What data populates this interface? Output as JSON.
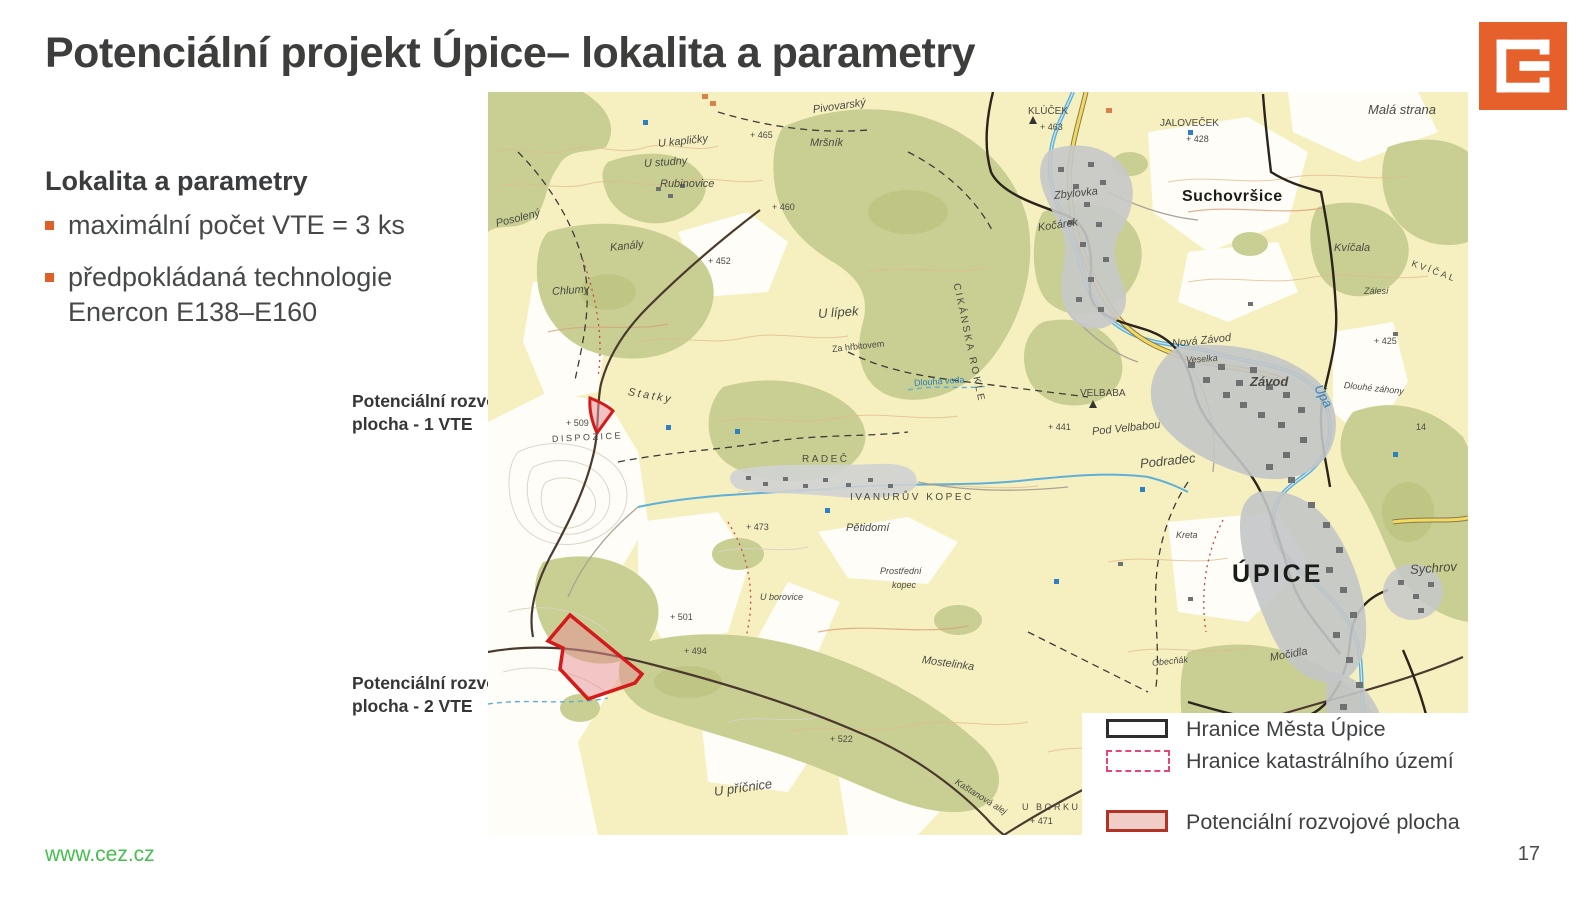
{
  "slide": {
    "title": "Potenciální projekt Úpice– lokalita a parametry",
    "page_number": "17",
    "footer_link": "www.cez.cz",
    "accent_orange": "#de5f28",
    "footer_green": "#43bf4c"
  },
  "logo": {
    "name": "cez-logo",
    "color": "#e5602b"
  },
  "panel": {
    "heading": "Lokalita a parametry",
    "bullets": [
      "maximální počet VTE = 3 ks",
      "předpokládaná technologie Enercon E138–E160"
    ]
  },
  "callouts": [
    {
      "label": "Potenciální rozvojová plocha - 1 VTE"
    },
    {
      "label": "Potenciální rozvojová plocha - 2 VTE"
    }
  ],
  "legend": {
    "items": [
      {
        "label": "Hranice Města Úpice",
        "swatch": "city-boundary"
      },
      {
        "label": "Hranice katastrálního území",
        "swatch": "cadastral-boundary"
      },
      {
        "label": "Potenciální rozvojové plocha",
        "swatch": "development-area"
      }
    ]
  },
  "map": {
    "colors": {
      "field_cream": "#f6f0c0",
      "forest_olive": "#c9cf92",
      "water_blue": "#5fb0d8",
      "road_dark": "#4a3a2e",
      "urban_gray": "#c3c5c7",
      "development_red": "#d41a1a",
      "development_fill": "#e89096",
      "cadastral_pink": "#e5467d"
    },
    "labels": [
      {
        "text": "Pivovarský",
        "x": 325,
        "y": 12,
        "cls": "it",
        "rot": -8
      },
      {
        "text": "Mršník",
        "x": 322,
        "y": 45,
        "cls": "it"
      },
      {
        "text": "+ 465",
        "x": 262,
        "y": 38,
        "cls": "xs"
      },
      {
        "text": "KLÚČEK",
        "x": 540,
        "y": 14,
        "cls": "sm"
      },
      {
        "text": "+ 463",
        "x": 552,
        "y": 30,
        "cls": "xs"
      },
      {
        "text": "JALOVEČEK",
        "x": 672,
        "y": 26,
        "cls": "sm"
      },
      {
        "text": "Malá strana",
        "x": 880,
        "y": 10,
        "cls": "it lg"
      },
      {
        "text": "+ 428",
        "x": 698,
        "y": 42,
        "cls": "xs"
      },
      {
        "text": "Suchovršice",
        "x": 694,
        "y": 96,
        "cls": "town"
      },
      {
        "text": "U kapličky",
        "x": 170,
        "y": 46,
        "cls": "it",
        "rot": -6
      },
      {
        "text": "U studny",
        "x": 156,
        "y": 66,
        "cls": "it",
        "rot": -4
      },
      {
        "text": "Rubinovice",
        "x": 172,
        "y": 86,
        "cls": "it"
      },
      {
        "text": "Posolený",
        "x": 8,
        "y": 126,
        "cls": "it",
        "rot": -14
      },
      {
        "text": "Kanály",
        "x": 122,
        "y": 150,
        "cls": "it",
        "rot": -6
      },
      {
        "text": "Chlumy",
        "x": 64,
        "y": 194,
        "cls": "it",
        "rot": -4
      },
      {
        "text": "+ 452",
        "x": 220,
        "y": 164,
        "cls": "xs"
      },
      {
        "text": "+ 460",
        "x": 284,
        "y": 110,
        "cls": "xs"
      },
      {
        "text": "U lípek",
        "x": 330,
        "y": 214,
        "cls": "it lg",
        "rot": -4
      },
      {
        "text": "Za hřbitovem",
        "x": 344,
        "y": 252,
        "cls": "xs",
        "rot": -6
      },
      {
        "text": "CIKÁNSKA ROKLE",
        "x": 468,
        "y": 186,
        "cls": "sm sp",
        "rot": 78
      },
      {
        "text": "Zbylovka",
        "x": 566,
        "y": 98,
        "cls": "it",
        "rot": -6
      },
      {
        "text": "Kočárek",
        "x": 550,
        "y": 130,
        "cls": "it",
        "rot": -8
      },
      {
        "text": "Kvíčala",
        "x": 846,
        "y": 150,
        "cls": "it"
      },
      {
        "text": "Zálesí",
        "x": 876,
        "y": 194,
        "cls": "xs it"
      },
      {
        "text": "KVÍČAL",
        "x": 924,
        "y": 166,
        "cls": "xs sp",
        "rot": 20
      },
      {
        "text": "Dlouhá voda",
        "x": 426,
        "y": 286,
        "cls": "xs blue",
        "rot": -4
      },
      {
        "text": "Statky",
        "x": 140,
        "y": 294,
        "cls": "it sp",
        "rot": 10
      },
      {
        "text": "+ 509",
        "x": 78,
        "y": 326,
        "cls": "xs"
      },
      {
        "text": "DISPOZICE",
        "x": 64,
        "y": 342,
        "cls": "xs sp",
        "rot": -3
      },
      {
        "text": "RADEČ",
        "x": 314,
        "y": 362,
        "cls": "sm lg sp"
      },
      {
        "text": "IVANURŮV KOPEC",
        "x": 362,
        "y": 400,
        "cls": "sm sp"
      },
      {
        "text": "Pětidomí",
        "x": 358,
        "y": 430,
        "cls": "it"
      },
      {
        "text": "+ 473",
        "x": 258,
        "y": 430,
        "cls": "xs"
      },
      {
        "text": "VELBABA",
        "x": 592,
        "y": 296,
        "cls": "sm"
      },
      {
        "text": "Nová Závod",
        "x": 684,
        "y": 246,
        "cls": "it",
        "rot": -6
      },
      {
        "text": "Veselka",
        "x": 698,
        "y": 263,
        "cls": "xs it",
        "rot": -4
      },
      {
        "text": "Závod",
        "x": 762,
        "y": 282,
        "cls": "lg it bold"
      },
      {
        "text": "Úpa",
        "x": 830,
        "y": 286,
        "cls": "blue it lg",
        "rot": 62
      },
      {
        "text": "Dlouhé záhony",
        "x": 856,
        "y": 288,
        "cls": "xs it",
        "rot": 6
      },
      {
        "text": "Pod Velbabou",
        "x": 604,
        "y": 334,
        "cls": "it",
        "rot": -6
      },
      {
        "text": "Podradec",
        "x": 652,
        "y": 364,
        "cls": "it lg",
        "rot": -6
      },
      {
        "text": "+ 441",
        "x": 560,
        "y": 330,
        "cls": "xs"
      },
      {
        "text": "+ 425",
        "x": 886,
        "y": 244,
        "cls": "xs"
      },
      {
        "text": "14",
        "x": 928,
        "y": 330,
        "cls": "xs"
      },
      {
        "text": "Kreta",
        "x": 688,
        "y": 438,
        "cls": "xs it"
      },
      {
        "text": "ÚPICE",
        "x": 744,
        "y": 468,
        "cls": "city"
      },
      {
        "text": "Sychrov",
        "x": 922,
        "y": 470,
        "cls": "it lg",
        "rot": -4
      },
      {
        "text": "Prostřední",
        "x": 392,
        "y": 474,
        "cls": "xs it"
      },
      {
        "text": "kopec",
        "x": 404,
        "y": 488,
        "cls": "xs it"
      },
      {
        "text": "U borovice",
        "x": 272,
        "y": 500,
        "cls": "xs it"
      },
      {
        "text": "+ 501",
        "x": 182,
        "y": 520,
        "cls": "xs"
      },
      {
        "text": "+ 494",
        "x": 196,
        "y": 554,
        "cls": "xs"
      },
      {
        "text": "Obecňák",
        "x": 664,
        "y": 566,
        "cls": "xs it",
        "rot": -6
      },
      {
        "text": "Močidla",
        "x": 782,
        "y": 560,
        "cls": "it",
        "rot": -10
      },
      {
        "text": "Mostelinka",
        "x": 434,
        "y": 562,
        "cls": "it",
        "rot": 8
      },
      {
        "text": "+ 522",
        "x": 342,
        "y": 642,
        "cls": "xs"
      },
      {
        "text": "U příčnice",
        "x": 226,
        "y": 692,
        "cls": "it lg",
        "rot": -8
      },
      {
        "text": "Kaštanová alej",
        "x": 468,
        "y": 684,
        "cls": "xs it",
        "rot": 32
      },
      {
        "text": "U BORKU",
        "x": 534,
        "y": 710,
        "cls": "xs sp"
      },
      {
        "text": "+ 471",
        "x": 542,
        "y": 724,
        "cls": "xs"
      }
    ]
  }
}
